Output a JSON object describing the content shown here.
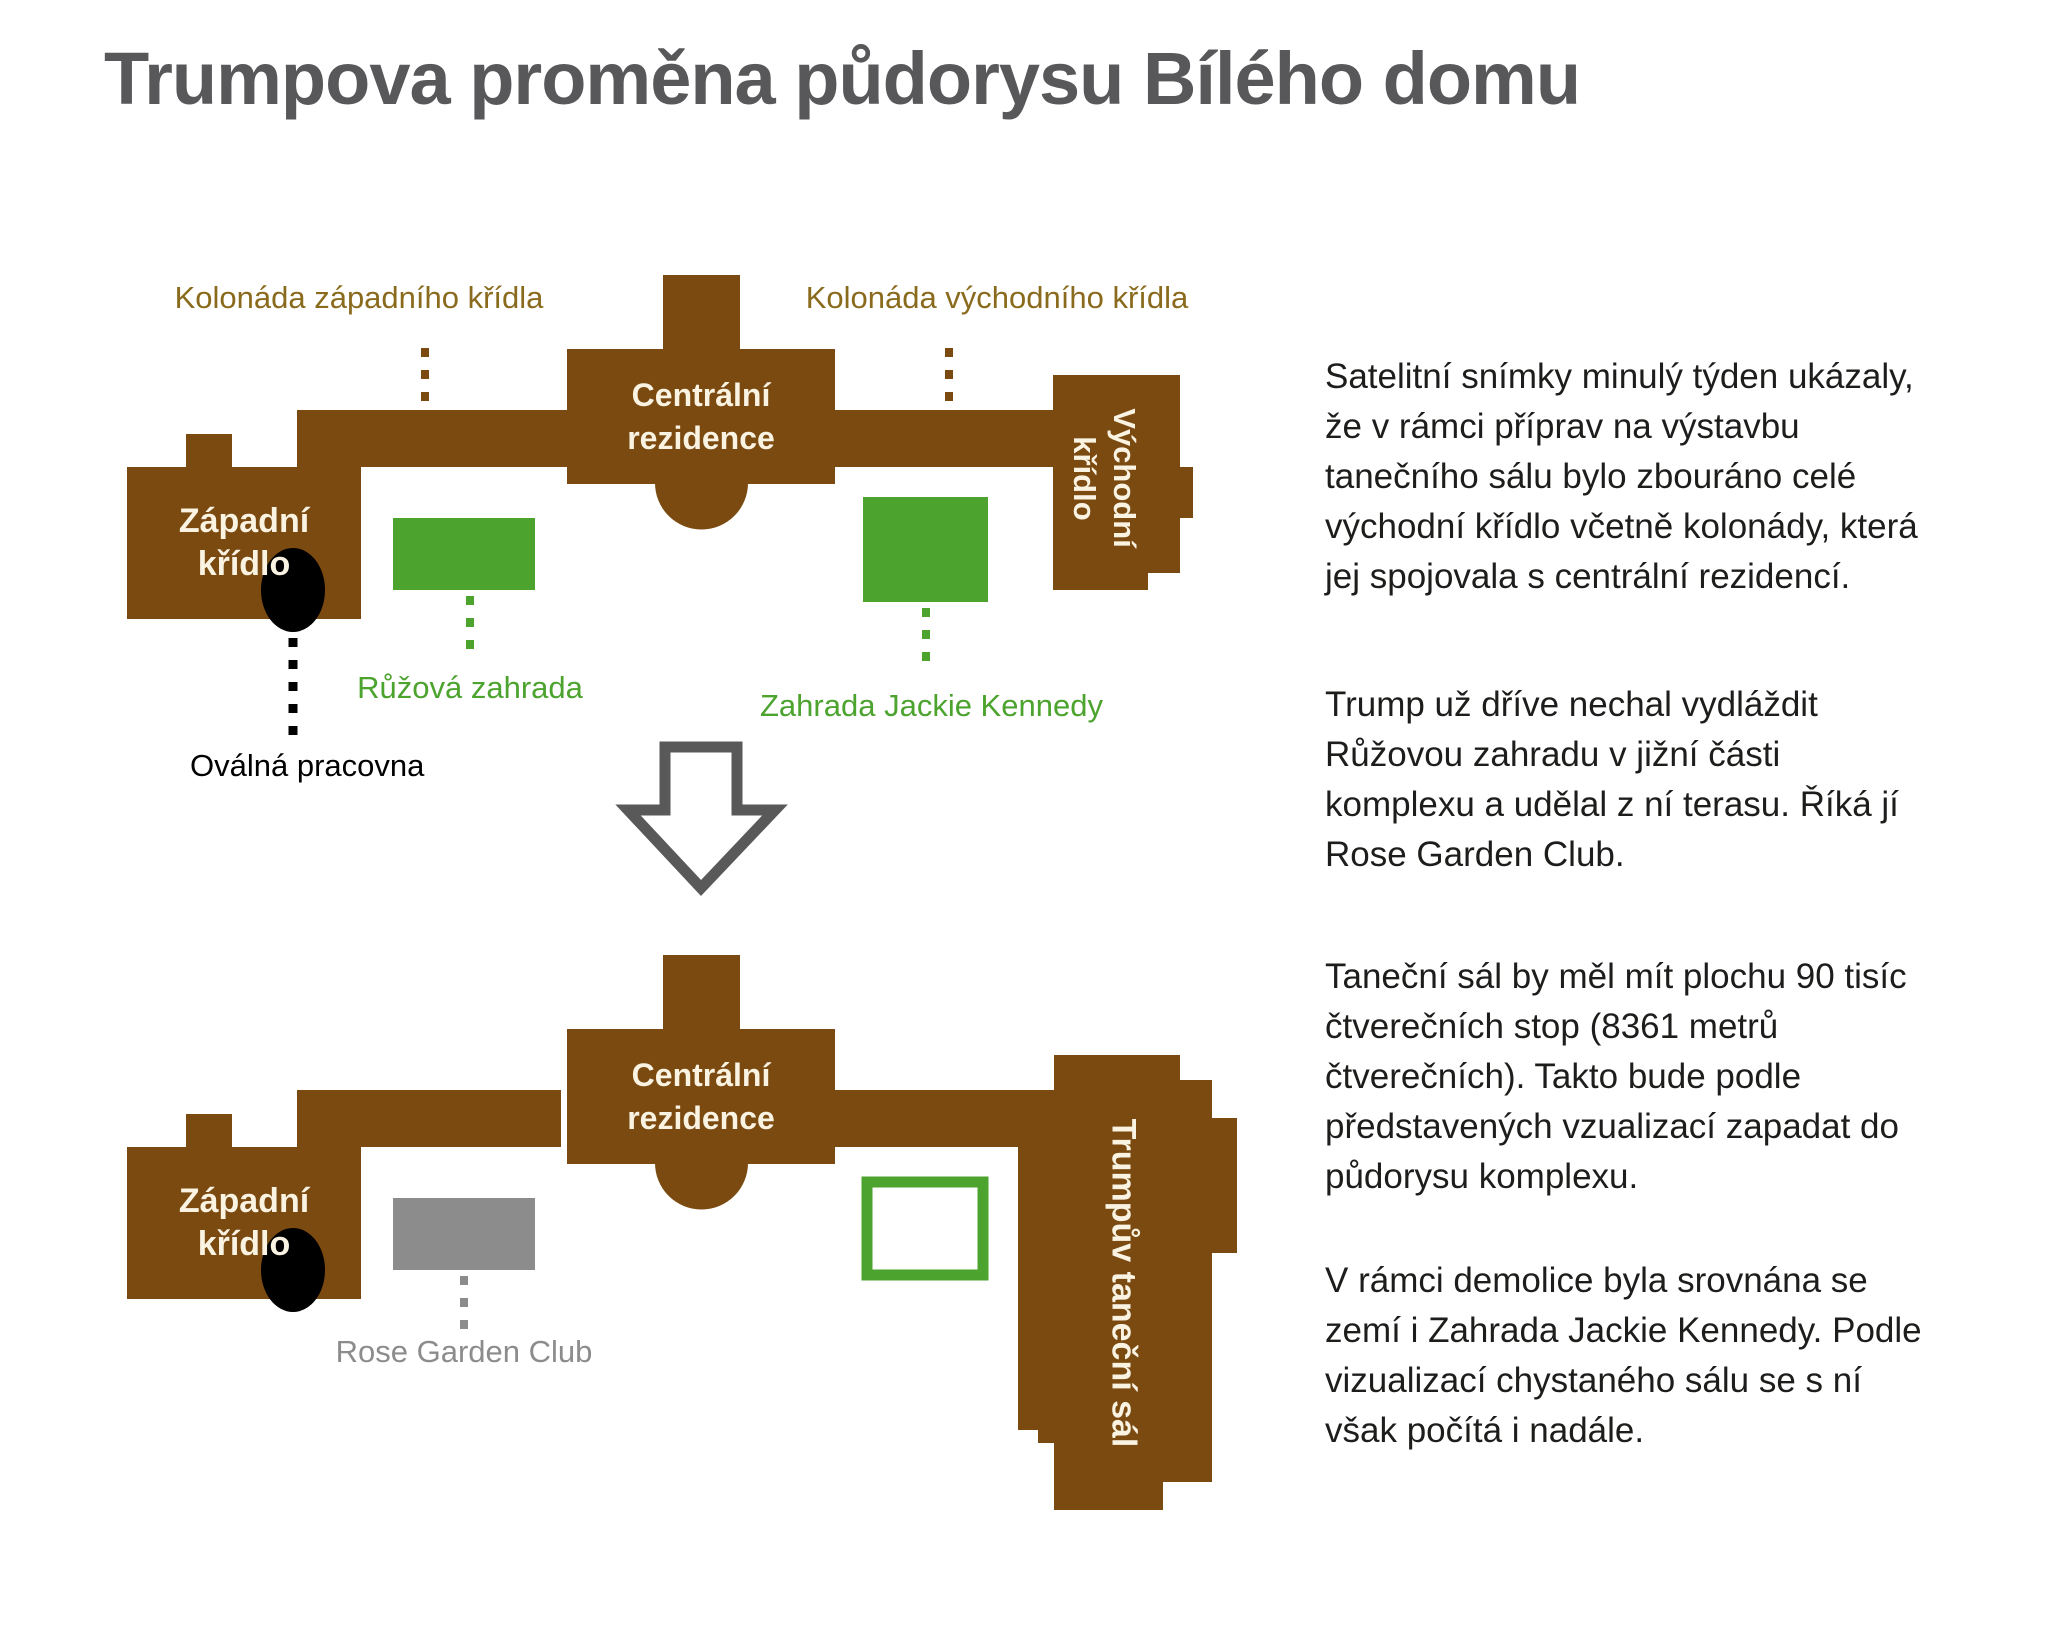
{
  "title": "Trumpova proměna půdorysu Bílého domu",
  "colors": {
    "building_brown": "#7a4a10",
    "colonnade_label_gold": "#8a6b1d",
    "garden_green": "#4ca32e",
    "neutral_gray": "#8c8c8c",
    "title_gray": "#58585a",
    "body_text": "#1d1d1b",
    "building_text_cream": "#faf3e2",
    "arrow_gray": "#595959",
    "oval_black": "#000000"
  },
  "before_plan": {
    "west_colonnade_label": "Kolonáda západního křídla",
    "east_colonnade_label": "Kolonáda východního křídla",
    "central_residence_label": "Centrální\nrezidence",
    "west_wing_label": "Západní\nkřídlo",
    "east_wing_label": "Východní\nkřídlo",
    "rose_garden_label": "Růžová zahrada",
    "jackie_kennedy_garden_label": "Zahrada Jackie Kennedy",
    "oval_office_label": "Oválná pracovna"
  },
  "after_plan": {
    "central_residence_label": "Centrální\nrezidence",
    "west_wing_label": "Západní\nkřídlo",
    "rose_garden_club_label": "Rose Garden Club",
    "ballroom_label": "Trumpův taneční sál"
  },
  "article": {
    "paragraphs": [
      "Satelitní snímky minulý týden ukázaly,\nže v rámci příprav na výstavbu\ntanečního sálu bylo zbouráno celé\nvýchodní křídlo včetně kolonády, která\njej spojovala s centrální rezidencí.",
      "Trump už dříve nechal vydláždit\nRůžovou zahradu v jižní části\nkomplexu a udělal z ní terasu. Říká jí\nRose Garden Club.",
      "Taneční sál by měl mít plochu 90 tisíc\nčtverečních stop (8361 metrů\nčtverečních). Takto bude podle\npředstavených vzualizací zapadat do\npůdorysu komplexu.",
      "V rámci demolice byla srovnána se\nzemí i Zahrada Jackie Kennedy. Podle\nvizualizací chystaného sálu se s ní\nvšak počítá i nadále."
    ]
  }
}
